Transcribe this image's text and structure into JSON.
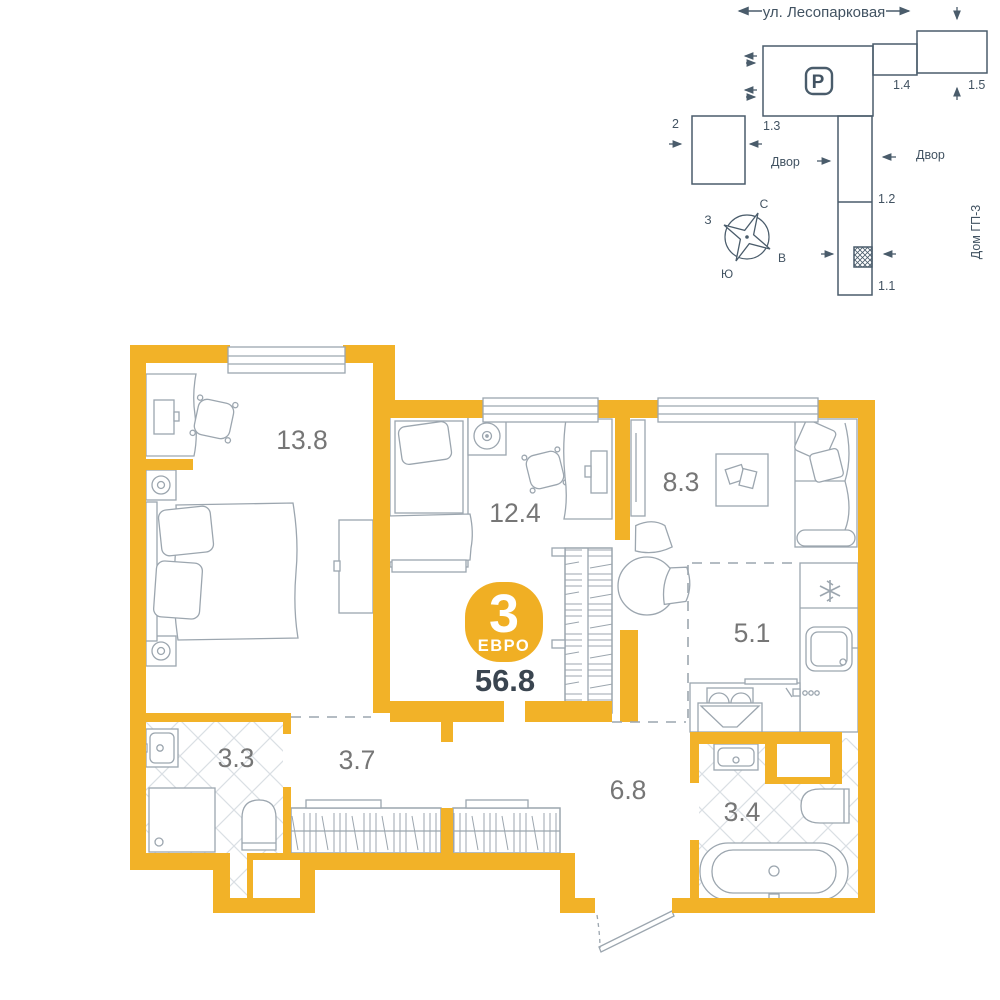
{
  "palette": {
    "wall_yellow": "#F2B228",
    "badge_yellow": "#F0AF24",
    "site_line": "#4A5C6B",
    "furniture_line": "#9CA6AF",
    "tile_line": "#DADFE4",
    "room_label_gray": "#767676",
    "area_dark": "#3A4550",
    "background": "#FFFFFF"
  },
  "site_plan": {
    "street": "ул. Лесопарковая",
    "parking_label": "P",
    "labels": {
      "parking_building": "1.3",
      "connector": "1.4",
      "building_right": "1.5",
      "section_mid": "1.2",
      "section_bottom": "1.1",
      "building_left": "2"
    },
    "yard_left": "Двор",
    "yard_right": "Двор",
    "house_name": "Дом ГП-3",
    "compass": {
      "n": "С",
      "s": "Ю",
      "w": "З",
      "e": "В"
    }
  },
  "apartment": {
    "rooms_count": "3",
    "type_label": "ЕВРО",
    "total_area": "56.8",
    "rooms": [
      {
        "name": "bedroom-1",
        "area": "13.8"
      },
      {
        "name": "bedroom-2",
        "area": "12.4"
      },
      {
        "name": "living-room",
        "area": "8.3"
      },
      {
        "name": "kitchen",
        "area": "5.1"
      },
      {
        "name": "bathroom-1",
        "area": "3.3"
      },
      {
        "name": "hallway",
        "area": "3.7"
      },
      {
        "name": "entrance-hall",
        "area": "6.8"
      },
      {
        "name": "bathroom-2",
        "area": "3.4"
      }
    ]
  }
}
